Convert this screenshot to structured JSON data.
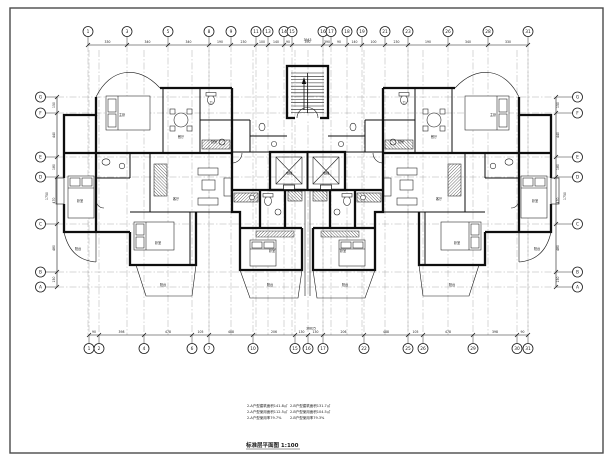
{
  "caption": "标准层平面图 1:100",
  "notes": {
    "col1": [
      "2-A户型建筑面积141.8㎡",
      "2-A户型使用面积112.5㎡",
      "2-A户型使用率79.7%"
    ],
    "col2": [
      "2-B户型建筑面积131.7㎡",
      "2-B户型使用面积104.5㎡",
      "2-B户型使用率79.3%"
    ]
  },
  "grid": {
    "top": {
      "labels": [
        "1",
        "3",
        "5",
        "8",
        "9",
        "11",
        "13",
        "14",
        "15",
        "16",
        "17",
        "18",
        "19",
        "21",
        "23",
        "26",
        "28",
        "31"
      ],
      "dims": [
        "330",
        "340",
        "340",
        "190",
        "230",
        "100",
        "140",
        "90",
        "390",
        "390",
        "90",
        "140",
        "100",
        "230",
        "190",
        "340",
        "330"
      ],
      "total": "3943"
    },
    "bottom": {
      "labels": [
        "1",
        "2",
        "4",
        "6",
        "7",
        "10",
        "15",
        "16",
        "17",
        "22",
        "25",
        "26",
        "29",
        "30",
        "31"
      ],
      "dims": [
        "90",
        "398",
        "478",
        "105",
        "488",
        "206",
        "130",
        "130",
        "206",
        "488",
        "105",
        "478",
        "398",
        "90"
      ],
      "total": "36825"
    },
    "left": {
      "labels": [
        "G",
        "F",
        "E",
        "D",
        "C",
        "B",
        "A"
      ],
      "dims": [
        "150",
        "440",
        "180",
        "470",
        "480",
        "150"
      ],
      "total": "1750"
    },
    "right": {
      "labels": [
        "G",
        "F",
        "E",
        "D",
        "C",
        "B",
        "A"
      ],
      "dims": [
        "150",
        "440",
        "180",
        "470",
        "480",
        "150"
      ],
      "total": "1750"
    }
  },
  "rooms": {
    "left": [
      "主卧",
      "餐厅",
      "卫",
      "厨房",
      "卧室",
      "客厅",
      "卧室",
      "卧室",
      "阳台",
      "阳台",
      "阳台"
    ],
    "core": [
      "电梯",
      "电梯"
    ]
  },
  "colors": {
    "ink": "#1a1a1a",
    "wall": "#0e0e0e",
    "grid": "#8c8c8c",
    "paper": "#ffffff"
  }
}
